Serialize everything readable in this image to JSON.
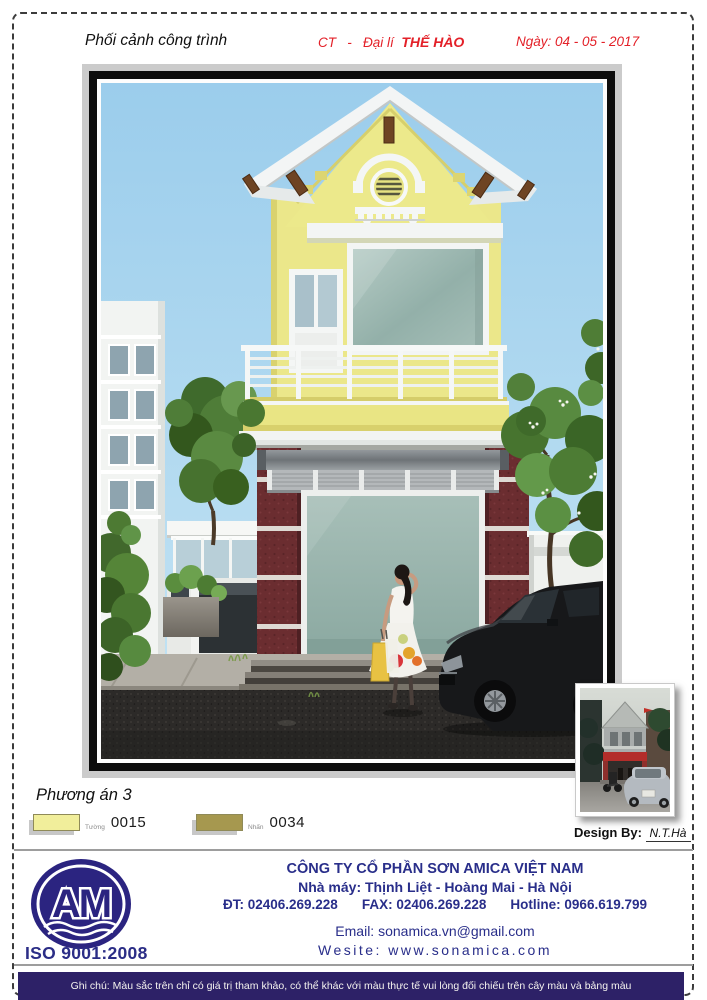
{
  "header": {
    "title": "Phối cảnh công trình",
    "ct": "CT",
    "sep": "-",
    "dealer_label": "Đại lí",
    "dealer_name": "THẾ HÀO",
    "date": "Ngày: 04 - 05 - 2017"
  },
  "plan_title": "Phương án 3",
  "swatches": [
    {
      "name": "Tường",
      "code": "0015",
      "color": "#f1ee9b"
    },
    {
      "name": "Nhấn",
      "code": "0034",
      "color": "#a6984f"
    }
  ],
  "design": {
    "label": "Design By:",
    "value": "N.T.Hà"
  },
  "logo": {
    "monogram": "AM",
    "iso": "ISO 9001:2008",
    "color": "#2b2480"
  },
  "company": {
    "name": "CÔNG TY CỔ PHẦN SƠN AMICA VIỆT NAM",
    "factory": "Nhà máy: Thịnh Liệt - Hoàng Mai - Hà Nội",
    "phone": "ĐT: 02406.269.228",
    "fax": "FAX: 02406.269.228",
    "hotline": "Hotline: 0966.619.799",
    "email": "Email: sonamica.vn@gmail.com",
    "website": "Wesite: www.sonamica.com"
  },
  "note": "Ghi chú: Màu sắc trên chỉ có giá trị tham khảo, có thể khác với màu thực tế vui lòng đối chiếu trên cây màu và bảng màu",
  "rendering": {
    "subject": "Front elevation perspective of a two-storey shop-house",
    "wall_color_code": "0015",
    "accent_color_code": "0034",
    "palette": {
      "sky": "#a9d6ef",
      "wall_yellow": "#ebe78a",
      "accent_maroon": "#6b2d30",
      "glass": "#9cb6af",
      "road": "#2c2a28"
    }
  }
}
